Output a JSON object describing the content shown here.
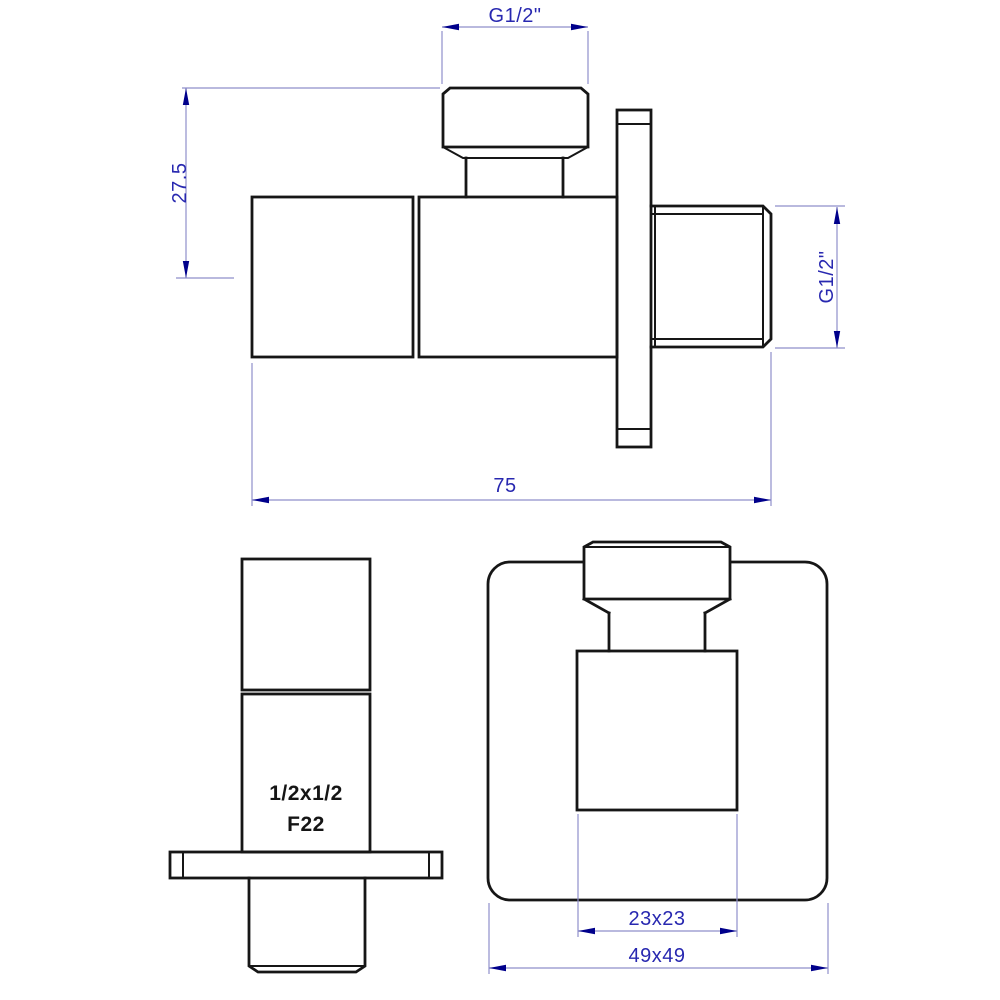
{
  "page": {
    "title": "Angle valve - technical drawing"
  },
  "colors": {
    "outline": "#161616",
    "dim_line": "#8f8fca",
    "dim_text": "#2828b0",
    "arrow": "#00008b",
    "background": "#ffffff"
  },
  "views": {
    "side": {
      "name": "side-elevation",
      "dims": {
        "top_thread": "G1/2\"",
        "height_to_axis": "27.5",
        "side_thread": "G1/2\"",
        "overall_length": "75"
      }
    },
    "front_valve": {
      "name": "front-view-valve",
      "markings": {
        "size": "1/2x1/2",
        "model": "F22"
      }
    },
    "front_plate": {
      "name": "front-view-on-wall-plate",
      "dims": {
        "body_face": "23x23",
        "plate_face": "49x49"
      }
    }
  }
}
